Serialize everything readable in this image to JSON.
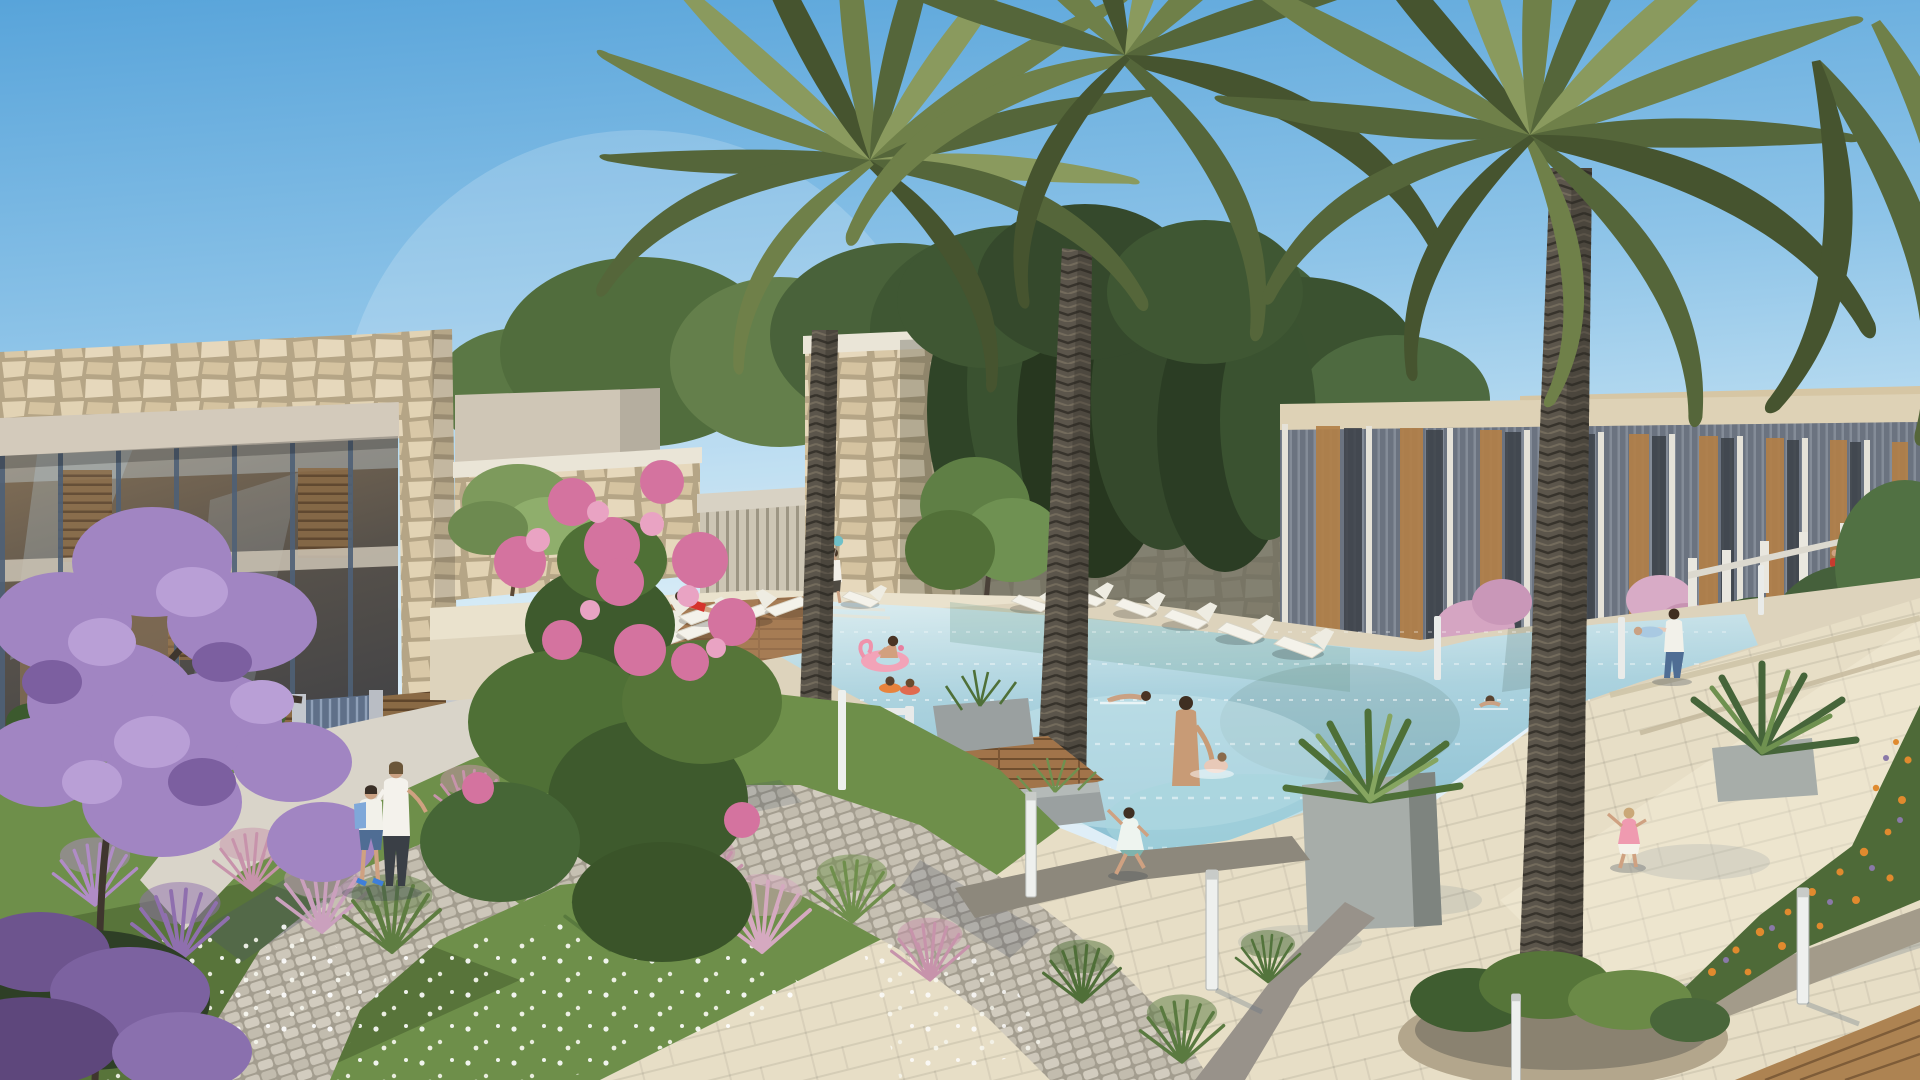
{
  "scene": {
    "type": "architectural-rendering",
    "setting": "resort residential community pool courtyard in warm late-day sunlight",
    "sky": "clear light-blue sky, pale near the horizon",
    "buildings": {
      "left_villa": "two-storey glass villa with rubble-stone parapet and corner pier, slate-blue mullions, warm timber interior, slatted garden gate",
      "pool_pavilions": "stone pool pavilions with white coping and a vertical-slat glass colonnade",
      "ivy_wall": "tall shaded stone wall overgrown with climbing greenery",
      "townhouse_row": "receding row of townhouses with grey vertical louvres, timber panels, beige fascia and white fence posts"
    },
    "pool": "large free-form swimming pool with travertine surround, wooden sun deck and stone planters",
    "palms": "two tall foreground date palms plus a mid-ground palm, feathered olive-green crowns",
    "garden": "foreground garden with purple jacaranda, pink bougainvillea, pink fountain grasses and a daisy lawn crossed by a cobble path",
    "people": [
      {
        "role": "woman-walking",
        "clothing": "white top, dark trousers"
      },
      {
        "role": "boy-walking",
        "clothing": "white tee, blue shorts, blue backpack"
      },
      {
        "role": "woman-sunbathing-on-lounger",
        "clothing": "red swimsuit"
      },
      {
        "role": "child-holding-balloons",
        "clothing": "white top, dark shorts"
      },
      {
        "role": "woman-on-flamingo-float",
        "clothing": "dark swimsuit, pink drink"
      },
      {
        "role": "two-children-with-swim-rings"
      },
      {
        "role": "swimmer-front-crawl"
      },
      {
        "role": "man-standing-in-pool-with-toddler",
        "clothing": "dark trunks"
      },
      {
        "role": "second-swimmer"
      },
      {
        "role": "woman-sitting-on-deck-edge",
        "clothing": "white top"
      },
      {
        "role": "girl-running-on-deck",
        "clothing": "white-teal dress"
      },
      {
        "role": "girl-in-pink-by-pool",
        "clothing": "pink top, white shorts"
      },
      {
        "role": "father-playing-airplane-with-child",
        "clothing": "white tee, jeans"
      },
      {
        "role": "toddlers-on-red-ride-on-car"
      }
    ],
    "furniture": {
      "sun_loungers_far_row": 5,
      "sun_loungers_left_group": 6,
      "poolside_chairs": 2,
      "bollard_lights": 7
    },
    "balloons": [
      "#d94f43",
      "#e8c23a",
      "#6fc0c8",
      "#f2f2f2"
    ]
  },
  "palette": {
    "sky_top": "#5fa8dc",
    "sky_horizon": "#d9edf8",
    "water_far": "#dcedf0",
    "water_mid": "#a7cedb",
    "water_near": "#8abfd2",
    "water_light_patch": "#c8e6ec",
    "stone": "#d9c8a9",
    "stone_grout": "#b5a586",
    "concrete": "#d3cabb",
    "town_fascia": "#ded2b6",
    "white_trim": "#eae5d7",
    "mullion": "#4e6076",
    "glass_warm": "#7a6850",
    "glass_dark": "#3a3d44",
    "louvre": "#6b7380",
    "timber": "#b28048",
    "white_post": "#e9e7df",
    "ivy_wall": "#8f8b80",
    "ivy_dark": "#2f4427",
    "leaf_mid": "#4f7038",
    "leaf_light": "#6f9150",
    "frond_dark": "#46542f",
    "frond_mid": "#6f8049",
    "frond_light": "#8a9a5e",
    "trunk": "#5b554b",
    "travertine": "#e7dec6",
    "travertine_shade": "#cfc4a8",
    "curb": "#8d887c",
    "cobble": "#c6c0b2",
    "wood_deck": "#a1744a",
    "wood_dark": "#6e4c2c",
    "grass": "#6e8f4a",
    "grass_dark": "#4c6434",
    "jacaranda": "#a185c2",
    "jacaranda_deep": "#7c5fa0",
    "bougainvillea": "#d4739f",
    "pink_grass": "#c793ab",
    "orange_flower": "#e08a2e",
    "flamingo_pink": "#f2a3b8",
    "lounger": "#f4f2ea",
    "skin": "#cfa181",
    "denim": "#4f6d94",
    "red_swimsuit": "#d5332c",
    "shadow_blue": "#5d7184"
  }
}
